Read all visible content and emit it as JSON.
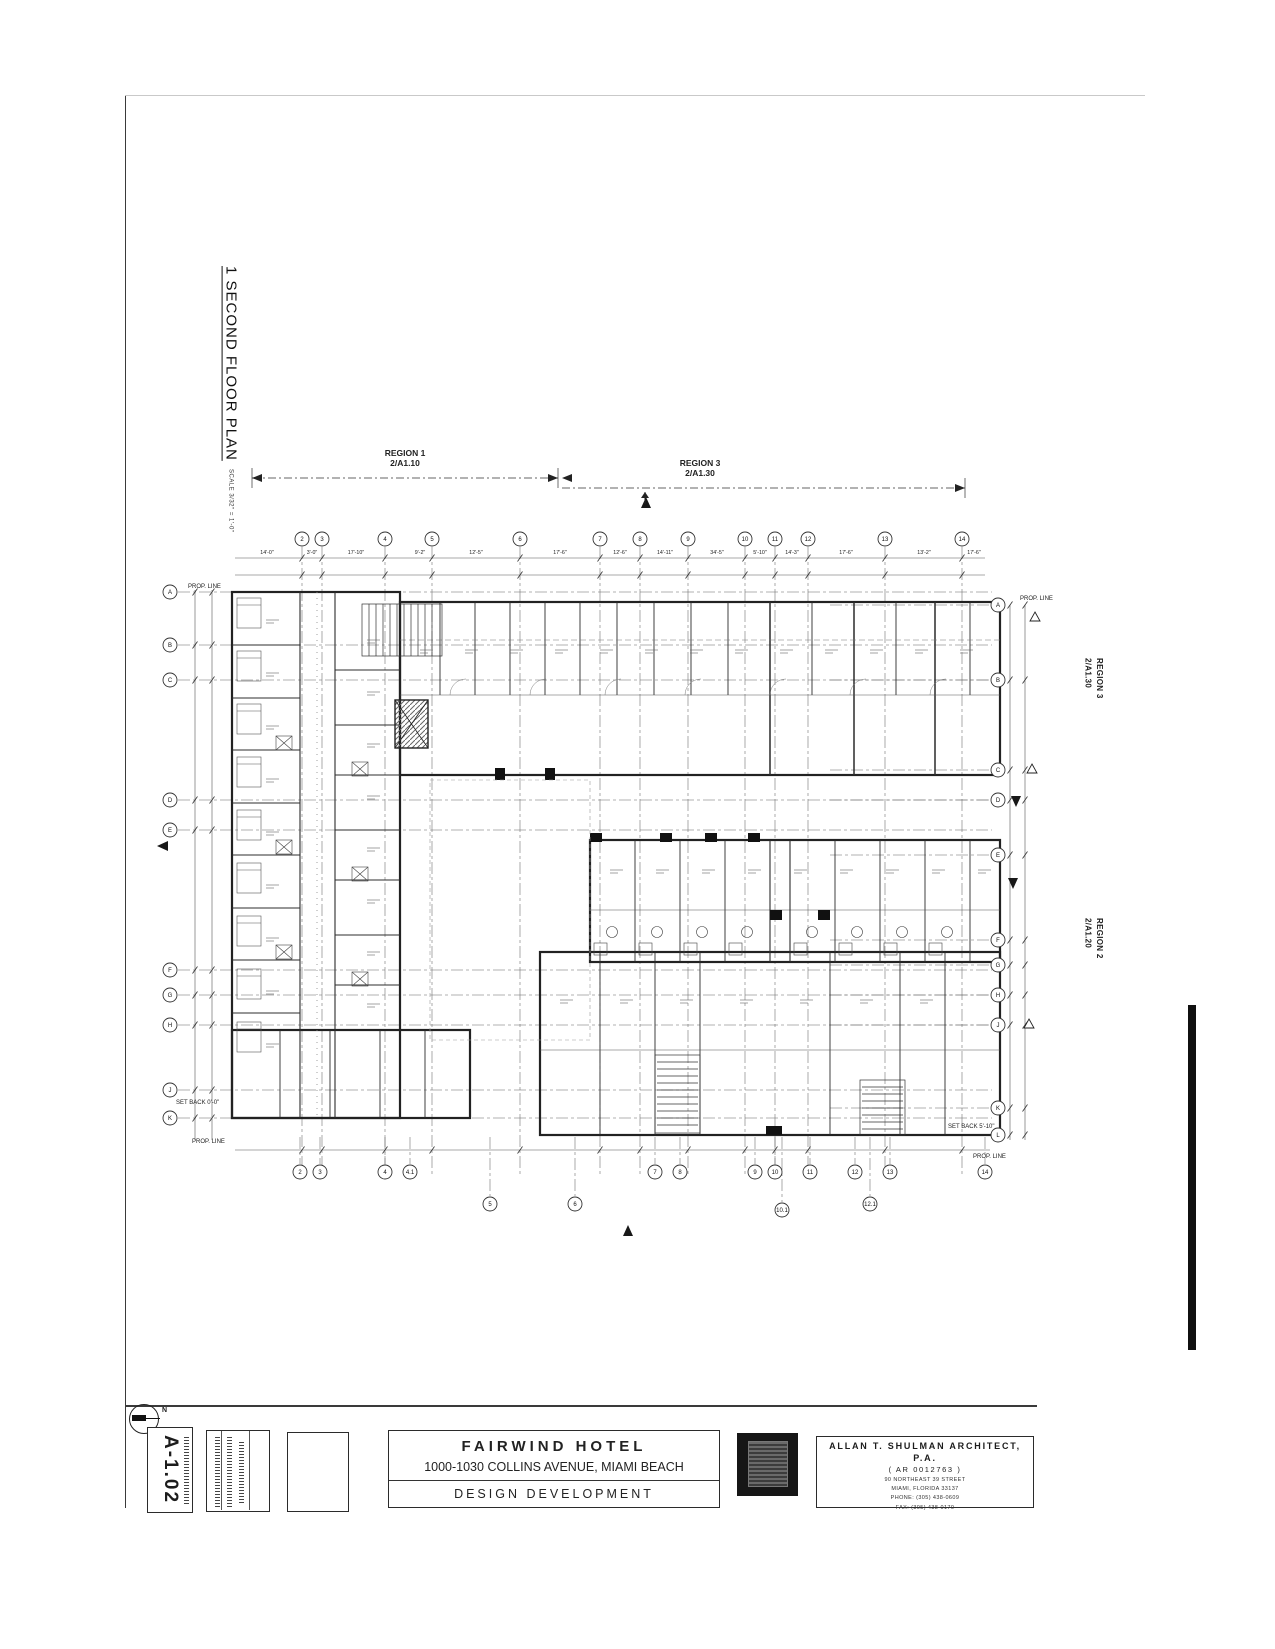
{
  "sheet": {
    "drawing_number": "A-1.02",
    "drawing_title": "1  SECOND FLOOR PLAN",
    "drawing_scale": "SCALE  3/32\" = 1'-0\"",
    "north_label": "N",
    "line_color": "#2b2b2b",
    "paper_color": "#ffffff"
  },
  "title_block": {
    "project_name": "FAIRWIND HOTEL",
    "project_address": "1000-1030 COLLINS AVENUE, MIAMI BEACH",
    "project_phase": "DESIGN DEVELOPMENT",
    "architect_name": "ALLAN T. SHULMAN ARCHITECT, P.A.",
    "architect_license": "( AR 0012763 )",
    "architect_address1": "90 NORTHEAST 39 STREET",
    "architect_address2": "MIAMI, FLORIDA 33137",
    "architect_phone": "PHONE: (305) 438-0609",
    "architect_fax": "FAX: (305) 438-0170"
  },
  "regions": {
    "region1": {
      "label": "REGION 1",
      "ref": "2/A1.10"
    },
    "region3_top": {
      "label": "REGION 3",
      "ref": "2/A1.30"
    },
    "region3_right": {
      "label": "REGION 3",
      "ref": "2/A1.30"
    },
    "region2_right": {
      "label": "REGION 2",
      "ref": "2/A1.20"
    }
  },
  "plan": {
    "grid_v": [
      {
        "x": 172,
        "label": "2"
      },
      {
        "x": 192,
        "label": "3"
      },
      {
        "x": 255,
        "label": "4"
      },
      {
        "x": 302,
        "label": "5"
      },
      {
        "x": 390,
        "label": "6"
      },
      {
        "x": 470,
        "label": "7"
      },
      {
        "x": 510,
        "label": "8"
      },
      {
        "x": 558,
        "label": "9"
      },
      {
        "x": 615,
        "label": "10"
      },
      {
        "x": 645,
        "label": "11"
      },
      {
        "x": 678,
        "label": "12"
      },
      {
        "x": 755,
        "label": "13"
      },
      {
        "x": 832,
        "label": "14"
      }
    ],
    "grid_h": [
      {
        "y": 152,
        "label": "A"
      },
      {
        "y": 205,
        "label": "B"
      },
      {
        "y": 240,
        "label": "C"
      },
      {
        "y": 360,
        "label": "D"
      },
      {
        "y": 390,
        "label": "E"
      },
      {
        "y": 530,
        "label": "F"
      },
      {
        "y": 555,
        "label": "G"
      },
      {
        "y": 585,
        "label": "H"
      },
      {
        "y": 650,
        "label": "J"
      },
      {
        "y": 678,
        "label": "K"
      }
    ],
    "bubbles_right": [
      {
        "y": 165,
        "label": "A"
      },
      {
        "y": 240,
        "label": "B"
      },
      {
        "y": 330,
        "label": "C"
      },
      {
        "y": 360,
        "label": "D"
      },
      {
        "y": 415,
        "label": "E"
      },
      {
        "y": 500,
        "label": "F"
      },
      {
        "y": 525,
        "label": "G"
      },
      {
        "y": 555,
        "label": "H"
      },
      {
        "y": 585,
        "label": "J"
      },
      {
        "y": 668,
        "label": "K"
      },
      {
        "y": 695,
        "label": "L"
      }
    ],
    "bubbles_bottom": [
      {
        "x": 170,
        "y": 732,
        "label": "2"
      },
      {
        "x": 190,
        "y": 732,
        "label": "3"
      },
      {
        "x": 255,
        "y": 732,
        "label": "4"
      },
      {
        "x": 280,
        "y": 732,
        "label": "4.1"
      },
      {
        "x": 525,
        "y": 732,
        "label": "7"
      },
      {
        "x": 550,
        "y": 732,
        "label": "8"
      },
      {
        "x": 625,
        "y": 732,
        "label": "9"
      },
      {
        "x": 645,
        "y": 732,
        "label": "10"
      },
      {
        "x": 680,
        "y": 732,
        "label": "11"
      },
      {
        "x": 725,
        "y": 732,
        "label": "12"
      },
      {
        "x": 760,
        "y": 732,
        "label": "13"
      },
      {
        "x": 855,
        "y": 732,
        "label": "14"
      },
      {
        "x": 360,
        "y": 764,
        "label": "5"
      },
      {
        "x": 445,
        "y": 764,
        "label": "6"
      },
      {
        "x": 652,
        "y": 770,
        "label": "10.1"
      },
      {
        "x": 740,
        "y": 764,
        "label": "12.1"
      }
    ],
    "dims_top": [
      {
        "x": 137,
        "t": "14'-0\""
      },
      {
        "x": 182,
        "t": "3'-0\""
      },
      {
        "x": 226,
        "t": "17'-10\""
      },
      {
        "x": 290,
        "t": "9'-2\""
      },
      {
        "x": 346,
        "t": "12'-5\""
      },
      {
        "x": 430,
        "t": "17'-6\""
      },
      {
        "x": 490,
        "t": "12'-6\""
      },
      {
        "x": 535,
        "t": "14'-11\""
      },
      {
        "x": 587,
        "t": "34'-5\""
      },
      {
        "x": 630,
        "t": "5'-10\""
      },
      {
        "x": 662,
        "t": "14'-3\""
      },
      {
        "x": 716,
        "t": "17'-6\""
      },
      {
        "x": 794,
        "t": "13'-2\""
      },
      {
        "x": 844,
        "t": "17'-6\""
      }
    ],
    "labels": [
      {
        "x": 58,
        "y": 148,
        "t": "PROP. LINE"
      },
      {
        "x": 890,
        "y": 160,
        "t": "PROP. LINE"
      },
      {
        "x": 62,
        "y": 703,
        "t": "PROP. LINE"
      },
      {
        "x": 843,
        "y": 718,
        "t": "PROP. LINE"
      },
      {
        "x": 46,
        "y": 664,
        "t": "SET BACK 0'-0\""
      },
      {
        "x": 818,
        "y": 688,
        "t": "SET BACK 5'-10\""
      }
    ],
    "deltas": [
      {
        "x": 905,
        "y": 178
      },
      {
        "x": 902,
        "y": 330
      },
      {
        "x": 899,
        "y": 585
      }
    ],
    "arrows": [
      {
        "x": 886,
        "y": 360,
        "dir": "down"
      },
      {
        "x": 883,
        "y": 442,
        "dir": "down"
      },
      {
        "x": 498,
        "y": 792,
        "dir": "up"
      },
      {
        "x": 34,
        "y": 406,
        "dir": "left"
      },
      {
        "x": 516,
        "y": 64,
        "dir": "up"
      }
    ]
  }
}
